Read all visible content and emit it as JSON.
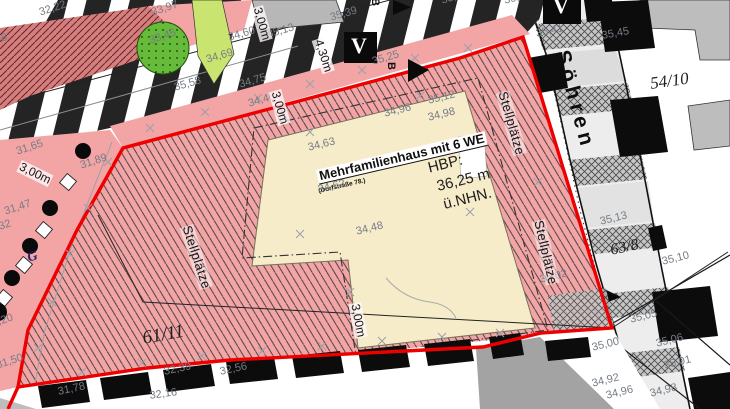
{
  "map": {
    "street": {
      "name": "Söhren",
      "x": 572,
      "y": 48,
      "rot": 75
    },
    "building": {
      "label": "Mehrfamilienhaus mit 6 WE",
      "sublabel": "(Dorfstraße 78.)",
      "hbp_line1": "HBP:",
      "hbp_line2": "36,25 m",
      "hbp_line3": "ü.NHN."
    },
    "markers": {
      "v": "V",
      "b": "B",
      "g": "G"
    },
    "colors": {
      "boundary_red": "#ee0000",
      "area_pink": "#f3a5a5",
      "building_beige": "#f6ecca",
      "tree_green": "#66bb3a",
      "strip_green": "#c9e570",
      "label_gray": "#757c85"
    },
    "parcel_labels": [
      {
        "text": "61/11",
        "x": 141,
        "y": 329,
        "rot": -10,
        "size": 19
      },
      {
        "text": "63/8",
        "x": 609,
        "y": 243,
        "rot": -12,
        "size": 16
      },
      {
        "text": "54/10",
        "x": 649,
        "y": 75,
        "rot": -8,
        "size": 17
      }
    ],
    "parking_labels": [
      {
        "text": "Stellplätze",
        "x": 193,
        "y": 224,
        "rot": 72
      },
      {
        "text": "Stellplätze",
        "x": 509,
        "y": 90,
        "rot": 74
      },
      {
        "text": "Stellplätze",
        "x": 545,
        "y": 219,
        "rot": 77
      }
    ],
    "dimensions": [
      {
        "text": "3,00m",
        "x": 263,
        "y": 5,
        "rot": 74
      },
      {
        "text": "3,00m",
        "x": 281,
        "y": 89,
        "rot": 74
      },
      {
        "text": "3,00m",
        "x": 22,
        "y": 160,
        "rot": 26
      },
      {
        "text": "3,00m",
        "x": 361,
        "y": 302,
        "rot": 79
      },
      {
        "text": "4,30m",
        "x": 324,
        "y": 37,
        "rot": 72
      }
    ],
    "elevations": [
      {
        "text": "32,22",
        "x": 38,
        "y": 8,
        "rot": -18
      },
      {
        "text": "33,97",
        "x": 150,
        "y": 8,
        "rot": -18
      },
      {
        "text": "33,45",
        "x": 148,
        "y": 36,
        "rot": -18
      },
      {
        "text": "31,98",
        "x": -21,
        "y": 38,
        "rot": -12
      },
      {
        "text": "34,60",
        "x": 227,
        "y": 33,
        "rot": -16
      },
      {
        "text": "35,13",
        "x": 266,
        "y": 30,
        "rot": -16
      },
      {
        "text": "34,69",
        "x": 205,
        "y": 55,
        "rot": -16
      },
      {
        "text": "35,58",
        "x": 173,
        "y": 83,
        "rot": -16
      },
      {
        "text": "34,75",
        "x": 238,
        "y": 80,
        "rot": -16
      },
      {
        "text": "34,46",
        "x": 247,
        "y": 99,
        "rot": -16
      },
      {
        "text": "35,39",
        "x": 329,
        "y": 13,
        "rot": -16
      },
      {
        "text": "35,57",
        "x": 440,
        "y": -4,
        "rot": -16
      },
      {
        "text": "35,37",
        "x": 503,
        "y": -4,
        "rot": -14
      },
      {
        "text": "35,25",
        "x": 371,
        "y": 57,
        "rot": -16
      },
      {
        "text": "31,65",
        "x": 15,
        "y": 147,
        "rot": -18
      },
      {
        "text": "31,89",
        "x": 79,
        "y": 161,
        "rot": -18
      },
      {
        "text": "31,47",
        "x": 3,
        "y": 207,
        "rot": -18
      },
      {
        "text": "31,32",
        "x": -17,
        "y": 227,
        "rot": -18
      },
      {
        "text": "31,20",
        "x": -15,
        "y": 321,
        "rot": -18
      },
      {
        "text": "31,50",
        "x": -5,
        "y": 361,
        "rot": -18
      },
      {
        "text": "31,78",
        "x": 57,
        "y": 387,
        "rot": -12
      },
      {
        "text": "32,39",
        "x": 163,
        "y": 367,
        "rot": -12
      },
      {
        "text": "32,16",
        "x": 149,
        "y": 391,
        "rot": -8
      },
      {
        "text": "32,56",
        "x": 219,
        "y": 367,
        "rot": -12
      },
      {
        "text": "34,96",
        "x": 383,
        "y": 109,
        "rot": -14
      },
      {
        "text": "35,12",
        "x": 427,
        "y": 96,
        "rot": -14
      },
      {
        "text": "34,98",
        "x": 427,
        "y": 113,
        "rot": -14
      },
      {
        "text": "34,63",
        "x": 307,
        "y": 143,
        "rot": -14
      },
      {
        "text": "34,62",
        "x": 317,
        "y": 185,
        "rot": -14
      },
      {
        "text": "34,48",
        "x": 355,
        "y": 227,
        "rot": -14
      },
      {
        "text": "35,41",
        "x": 535,
        "y": 29,
        "rot": -12
      },
      {
        "text": "35,45",
        "x": 601,
        "y": 31,
        "rot": -10
      },
      {
        "text": "35,13",
        "x": 599,
        "y": 217,
        "rot": -14
      },
      {
        "text": "35,10",
        "x": 661,
        "y": 257,
        "rot": -14
      },
      {
        "text": "35,02",
        "x": 539,
        "y": 275,
        "rot": -14
      },
      {
        "text": "35,05",
        "x": 629,
        "y": 315,
        "rot": -14
      },
      {
        "text": "35,00",
        "x": 591,
        "y": 343,
        "rot": -14
      },
      {
        "text": "35,06",
        "x": 655,
        "y": 339,
        "rot": -14
      },
      {
        "text": "35,01",
        "x": 663,
        "y": 361,
        "rot": -14
      },
      {
        "text": "33,90",
        "x": 509,
        "y": 367,
        "rot": -10,
        "color": "#a3a3a3"
      },
      {
        "text": "34,92",
        "x": 591,
        "y": 379,
        "rot": -14
      },
      {
        "text": "34,96",
        "x": 605,
        "y": 391,
        "rot": -14
      },
      {
        "text": "34,98",
        "x": 649,
        "y": 389,
        "rot": -14
      }
    ]
  }
}
